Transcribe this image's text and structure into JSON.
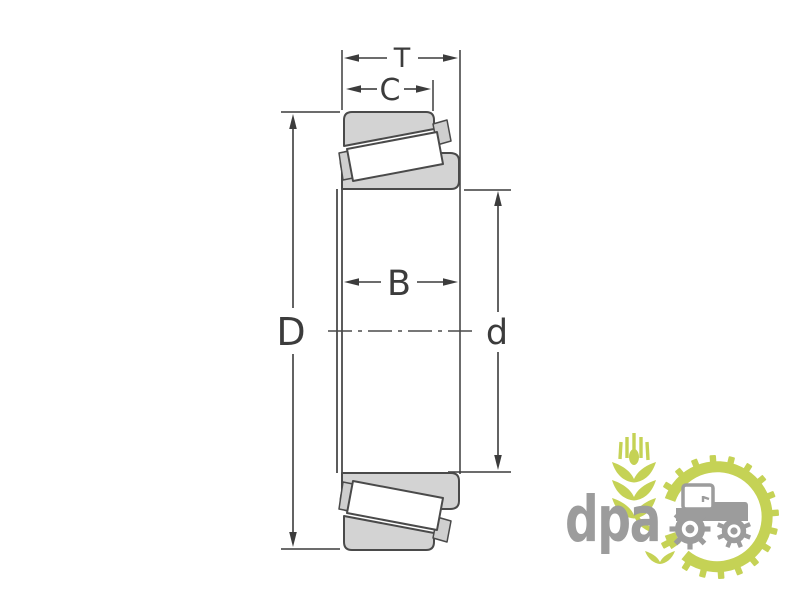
{
  "page": {
    "background_color": "#ffffff",
    "content": "Technical drawing of a tapered roller bearing cross-section with dimension annotations"
  },
  "diagram": {
    "type": "technical-drawing",
    "subject": "tapered-roller-bearing-cross-section",
    "labels": {
      "T": "T",
      "C": "C",
      "B": "B",
      "D": "D",
      "d": "d"
    },
    "colors": {
      "dimension_line": "#3c3c3c",
      "part_outline": "#4a4a4a",
      "part_fill": "#d3d3d3",
      "roller_fill": "#ffffff"
    }
  },
  "logo": {
    "text": "dpa",
    "icons": [
      "wheat-icon",
      "gear-ring-icon",
      "tractor-icon"
    ],
    "colors": {
      "green": "#c5d255",
      "gray": "#9c9c9c"
    }
  }
}
